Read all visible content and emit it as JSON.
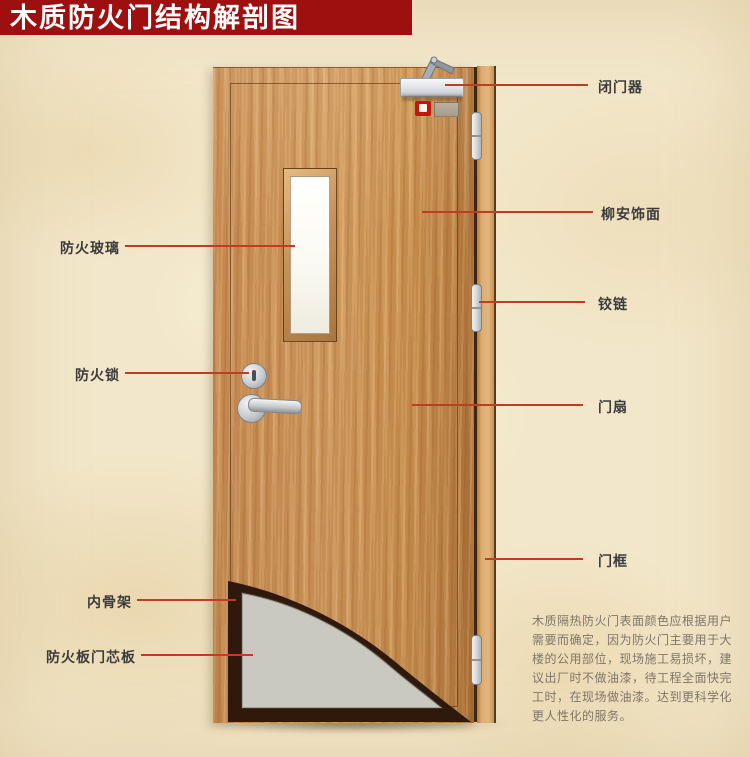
{
  "title": "木质防火门结构解剖图",
  "callouts": {
    "right": [
      {
        "label": "闭门器"
      },
      {
        "label": "柳安饰面"
      },
      {
        "label": "铰链"
      },
      {
        "label": "门扇"
      },
      {
        "label": "门框"
      }
    ],
    "left": [
      {
        "label": "防火玻璃"
      },
      {
        "label": "防火锁"
      },
      {
        "label": "内骨架"
      },
      {
        "label": "防火板门芯板"
      }
    ]
  },
  "description": {
    "lines": [
      "木质隔热防火门表面颜色应根据用户",
      "需要而确定，因为防火门主要用于大",
      "楼的公用部位，现场施工易损坏，建",
      "议出厂时不做油漆，待工程全面快完",
      "工时，在现场做油漆。达到更科学化",
      "更人性化的服务。"
    ]
  },
  "colors": {
    "banner_red": "#9e0f10",
    "leader_red": "#c23b25",
    "wood": "#c9914f",
    "frame_wood": "#dcae74",
    "core_gray": "#c9c8c1",
    "skeleton_dark": "#2e190c",
    "background_parchment": "#f2e7ca",
    "label_text": "#3c3c3c",
    "description_text": "#7e766a"
  }
}
